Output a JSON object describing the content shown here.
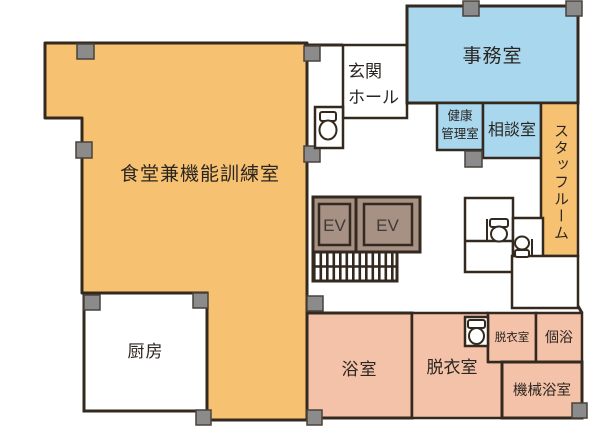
{
  "colors": {
    "dining": "#f7c172",
    "blue": "#a8d7ee",
    "pink": "#f4c2a8",
    "wall": "#34291f",
    "pillar": "#8b8b8b",
    "pillar_border": "#4a423a",
    "elevator": "#a79185",
    "text": "#2b2521",
    "ev_text": "#3f3a35",
    "white": "#ffffff"
  },
  "rooms": {
    "dining": {
      "label": "食堂兼機能訓練室"
    },
    "kitchen": {
      "label": "厨房"
    },
    "entrance_hall": {
      "label": "玄関\nホール"
    },
    "office": {
      "label": "事務室"
    },
    "health_management": {
      "label": "健康\n管理室"
    },
    "consultation": {
      "label": "相談室"
    },
    "staff_room": {
      "label": "スタッフルーム"
    },
    "elevator1": {
      "label": "EV"
    },
    "elevator2": {
      "label": "EV"
    },
    "bath": {
      "label": "浴室"
    },
    "dressing": {
      "label": "脱衣室"
    },
    "dressing_small": {
      "label": "脱衣室"
    },
    "private_bath": {
      "label": "個浴"
    },
    "machine_bath": {
      "label": "機械浴室"
    }
  }
}
